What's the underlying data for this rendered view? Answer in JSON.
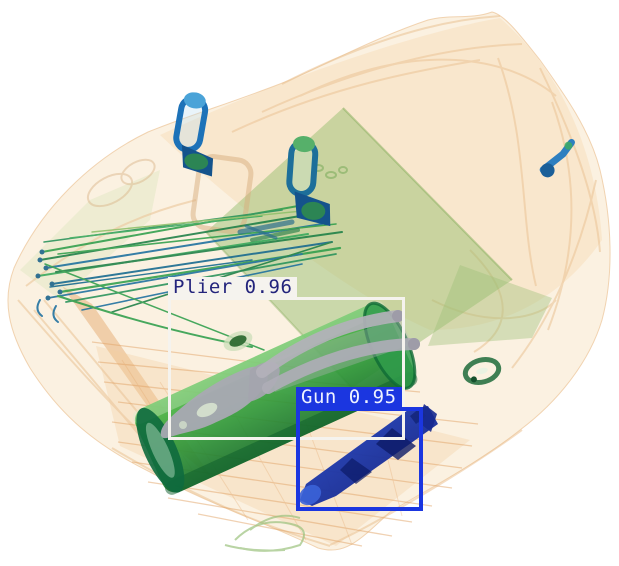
{
  "scan": {
    "image_type": "xray-baggage-scan",
    "background": "#ffffff"
  },
  "detections": [
    {
      "label": "Plier",
      "score": "0.96",
      "display": "Plier 0.96",
      "box": {
        "x": 168,
        "y": 297,
        "width": 237,
        "height": 143
      },
      "box_color": "#f5f3ee",
      "box_stroke": 3,
      "label_bg": "#f5f3ee",
      "label_text": "#23247c",
      "label_height": 21
    },
    {
      "label": "Gun",
      "score": "0.95",
      "display": "Gun 0.95",
      "box": {
        "x": 296,
        "y": 407,
        "width": 127,
        "height": 104
      },
      "box_color": "#1b36e0",
      "box_stroke": 4,
      "label_bg": "#1b36e0",
      "label_text": "#eef2ff",
      "label_height": 21
    }
  ],
  "palette": {
    "bag_organic": "#f6d4a4",
    "bag_outline": "#ecc79b",
    "folder_green": "#8fba68",
    "wire_green": "#2f9e4b",
    "wire_blue": "#1b6f9e",
    "case_green": "#2f9b3c",
    "metal_gray": "#adabb5",
    "gun_navy": "#14249a",
    "pull_blue": "#1d72b8"
  }
}
